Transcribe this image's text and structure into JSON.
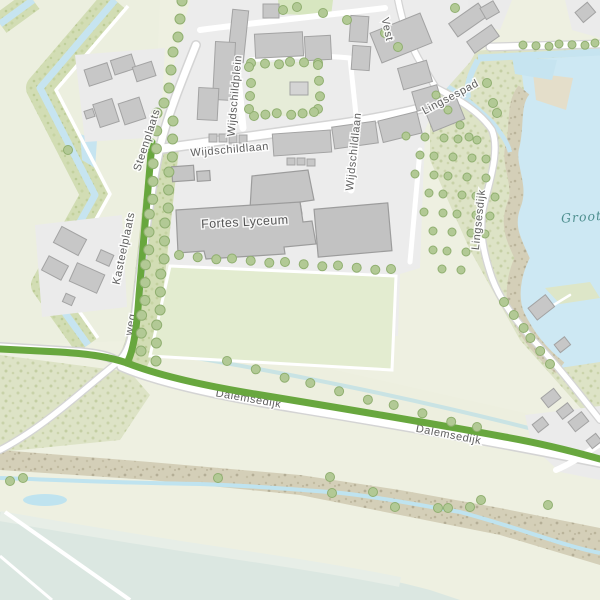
{
  "map": {
    "type": "topographic-street-map",
    "labels": {
      "fortes": "Fortes Lyceum",
      "wijdschildlaan_h": "Wijdschildlaan",
      "wijdschildlaan_v": "Wijdschildlaan",
      "wijdschildplein": "Wijdschildplein",
      "vest": "Vest",
      "lingsespad": "Lingsespad",
      "steenplaats": "Steenplaats",
      "kasteelplaats": "Kasteelplaats",
      "lingsesdijk": "Lingsesdijk",
      "dalemsedijk_1": "Dalemsedijk",
      "dalemsedijk_2": "Dalemsedijk",
      "weg_partial": "weg",
      "groote": "Groote"
    },
    "colors": {
      "route_green": "#68a73e",
      "water_blue": "#c6e4f0",
      "lake_blue": "#cde8f3",
      "river_pale": "#dce8e2",
      "urban_gray": "#ececec",
      "building_fill": "#c7c7c7",
      "building_stroke": "#a3a3a3",
      "road_white": "#ffffff",
      "road_casing": "#d4d4d4",
      "field_green": "#e3ecd0",
      "bank_green": "#d2ddb4",
      "scrub_tan": "#d6d0ba",
      "tree_fill": "#b2c995",
      "tree_stroke": "#90af70",
      "label_gray": "#5f5f5f",
      "water_label": "#4d8e8e"
    },
    "trees": {
      "lines": [
        {
          "x1": 183,
          "y1": 2,
          "x2": 165,
          "y2": 104,
          "n": 7,
          "r": 5
        },
        {
          "x1": 158,
          "y1": 114,
          "x2": 140,
          "y2": 350,
          "n": 15,
          "r": 5
        },
        {
          "x1": 174,
          "y1": 122,
          "x2": 155,
          "y2": 360,
          "n": 15,
          "r": 5
        },
        {
          "x1": 180,
          "y1": 256,
          "x2": 392,
          "y2": 270,
          "n": 13,
          "r": 4.5
        },
        {
          "x1": 524,
          "y1": 46,
          "x2": 596,
          "y2": 44,
          "n": 7,
          "r": 4
        },
        {
          "x1": 505,
          "y1": 303,
          "x2": 549,
          "y2": 363,
          "n": 6,
          "r": 4.5
        },
        {
          "x1": 437,
          "y1": 96,
          "x2": 470,
          "y2": 138,
          "n": 4,
          "r": 4
        },
        {
          "x1": 252,
          "y1": 64,
          "x2": 317,
          "y2": 62,
          "n": 6,
          "r": 4.5
        },
        {
          "x1": 319,
          "y1": 66,
          "x2": 319,
          "y2": 110,
          "n": 4,
          "r": 4.5
        },
        {
          "x1": 315,
          "y1": 113,
          "x2": 253,
          "y2": 115,
          "n": 6,
          "r": 4.5
        },
        {
          "x1": 250,
          "y1": 110,
          "x2": 250,
          "y2": 68,
          "n": 4,
          "r": 4.5
        },
        {
          "x1": 228,
          "y1": 362,
          "x2": 478,
          "y2": 428,
          "n": 10,
          "r": 4.5
        }
      ],
      "points": [
        [
          218,
          478
        ],
        [
          330,
          477
        ],
        [
          332,
          493
        ],
        [
          373,
          492
        ],
        [
          395,
          507
        ],
        [
          438,
          508
        ],
        [
          448,
          508
        ],
        [
          470,
          507
        ],
        [
          481,
          500
        ],
        [
          548,
          505
        ],
        [
          23,
          478
        ],
        [
          10,
          481
        ],
        [
          283,
          10
        ],
        [
          297,
          7
        ],
        [
          323,
          13
        ],
        [
          347,
          20
        ],
        [
          385,
          33
        ],
        [
          398,
          47
        ],
        [
          455,
          8
        ],
        [
          487,
          83
        ],
        [
          493,
          103
        ],
        [
          497,
          113
        ],
        [
          68,
          150
        ]
      ],
      "orchard": {
        "x0": 408,
        "y0": 138,
        "rows": 8,
        "dx": 17,
        "dy": 19,
        "drift": 4,
        "r": 4
      }
    }
  }
}
